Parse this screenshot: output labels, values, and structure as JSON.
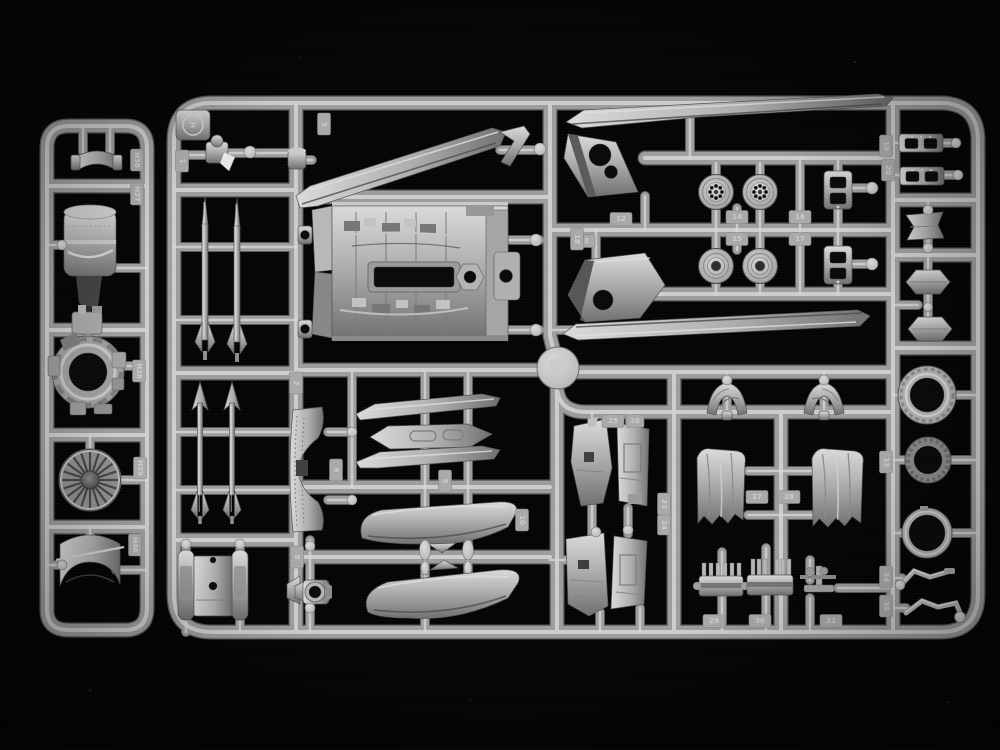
{
  "scene": {
    "alt": "Gray injection-molded polystyrene model kit sprue (parts tree) photographed on a black background, with a small ladder-shaped auxiliary sprue at the left"
  },
  "colors": {
    "background": "#050505",
    "runner_edge": "#5c5c5c",
    "runner_base": "#9d9d9d",
    "runner_highlight": "#d6d6d6",
    "plastic_highlight": "#dadada",
    "plastic_base": "#aeaeae",
    "plastic_shadow": "#707070",
    "part_edge": "#545454",
    "hole": "#0a0a0a",
    "tag_fill": "#a9a9a9",
    "tag_text": "#d2d2d2",
    "dark_face": "#434343"
  },
  "sprue_main": {
    "letter": "H"
  },
  "tags": {
    "h36": "H36",
    "h37": "H37",
    "h38": "H38",
    "h39": "H39",
    "h40": "H40",
    "t1": "1",
    "t2": "2",
    "t3": "3",
    "t5": "5",
    "t8": "8",
    "t9": "9",
    "t10": "10",
    "t12": "12",
    "t13": "13",
    "t14": "14",
    "t15": "15",
    "t16": "16",
    "t17": "17",
    "t18": "18",
    "t19": "19",
    "t20": "20",
    "t23": "23",
    "t24": "24",
    "t25": "25",
    "t26": "26",
    "t27": "27",
    "t28": "28",
    "t29": "29",
    "t30": "30",
    "t32": "32",
    "t33": "33",
    "t34": "34",
    "t35": "35"
  }
}
